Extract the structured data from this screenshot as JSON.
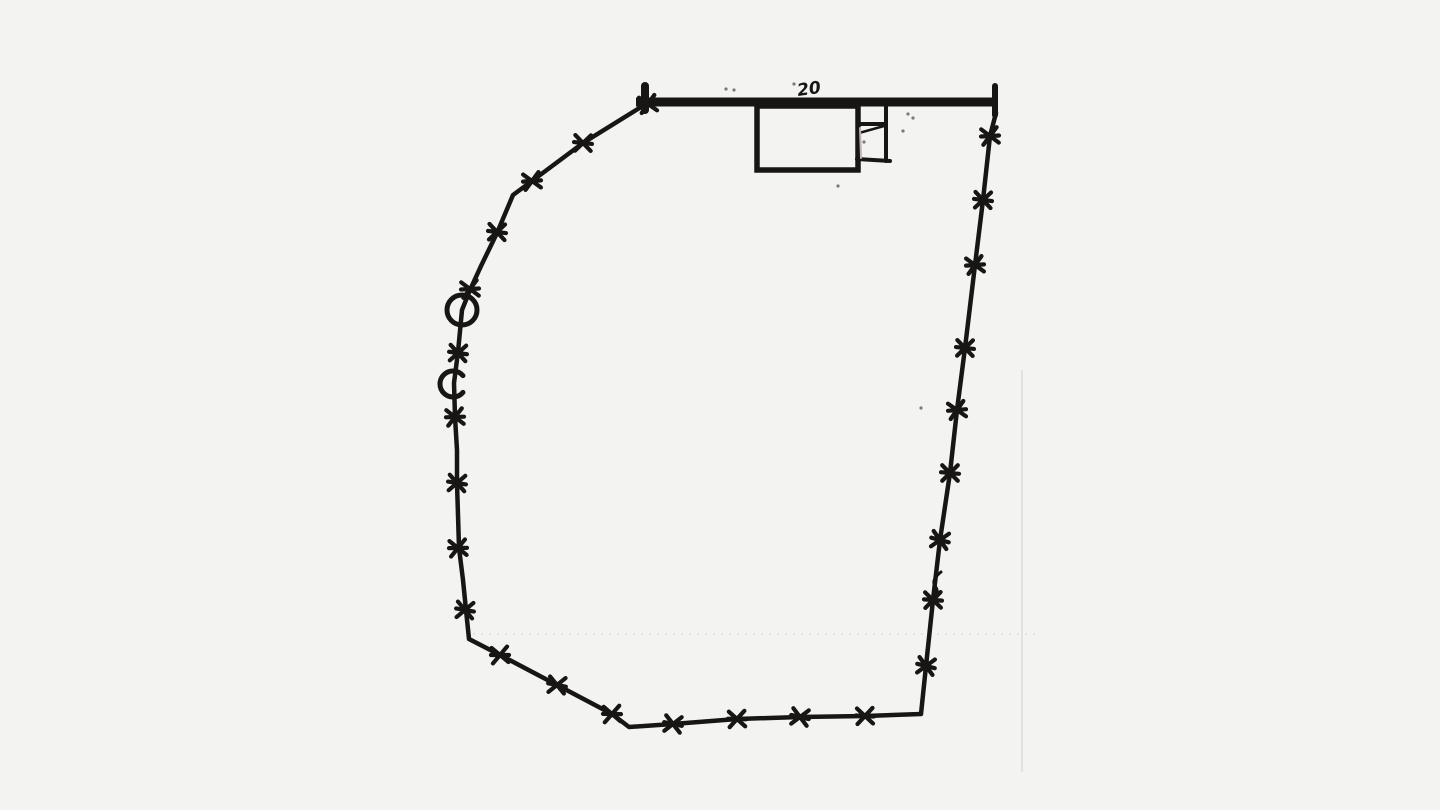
{
  "annotation": {
    "dimension_label": "20"
  },
  "colors": {
    "paper": "#f3f3f1",
    "ink": "#181614",
    "faint": "#dcdcd8",
    "pencil": "#b9b5ae"
  },
  "geometry": {
    "canvas": {
      "width": 1440,
      "height": 810
    },
    "top_wall": {
      "x1": 636,
      "y1": 102,
      "x2": 997,
      "y2": 102,
      "thickness": 9,
      "left_tick": {
        "x": 645,
        "y1": 86,
        "y2": 110,
        "thickness": 8
      },
      "right_cap": {
        "x": 995,
        "y1": 86,
        "y2": 115,
        "thickness": 6
      }
    },
    "dimension_label_pos": {
      "x": 798,
      "y": 96,
      "rotation": -8,
      "size": 17
    },
    "building": {
      "main_rect": {
        "x": 757,
        "y": 106,
        "w": 101,
        "h": 64,
        "stroke_w": 5.5
      },
      "annex": {
        "right_wall": {
          "x1": 886,
          "y1": 106,
          "x2": 886,
          "y2": 161,
          "w": 4
        },
        "divider": {
          "x1": 860,
          "y1": 124,
          "x2": 886,
          "y2": 124,
          "w": 4
        },
        "diagonal": {
          "x1": 859,
          "y1": 133,
          "x2": 884,
          "y2": 126,
          "w": 2.5
        },
        "bottom": {
          "x1": 857,
          "y1": 159,
          "x2": 890,
          "y2": 161,
          "w": 4
        },
        "pencil_mark": {
          "x1": 860,
          "y1": 128,
          "x2": 861,
          "y2": 158,
          "w": 2
        }
      }
    },
    "boundary": {
      "stroke_w": 4.5,
      "points": [
        [
          641,
          107
        ],
        [
          583,
          143
        ],
        [
          532,
          181
        ],
        [
          513,
          195
        ],
        [
          497,
          233
        ],
        [
          481,
          266
        ],
        [
          470,
          290
        ],
        [
          462,
          310
        ],
        [
          458,
          352
        ],
        [
          454,
          383
        ],
        [
          455,
          417
        ],
        [
          457,
          450
        ],
        [
          457,
          483
        ],
        [
          458,
          515
        ],
        [
          459,
          548
        ],
        [
          463,
          580
        ],
        [
          466,
          610
        ],
        [
          469,
          639
        ],
        [
          500,
          655
        ],
        [
          557,
          685
        ],
        [
          612,
          714
        ],
        [
          629,
          727
        ],
        [
          673,
          724
        ],
        [
          737,
          719
        ],
        [
          800,
          717
        ],
        [
          865,
          716
        ],
        [
          921,
          714
        ],
        [
          926,
          666
        ],
        [
          933,
          600
        ],
        [
          940,
          540
        ],
        [
          950,
          473
        ],
        [
          957,
          410
        ],
        [
          965,
          348
        ],
        [
          975,
          265
        ],
        [
          983,
          200
        ],
        [
          990,
          136
        ],
        [
          996,
          113
        ]
      ]
    },
    "posts": {
      "arm_length": 11,
      "stroke_w": 4.2,
      "positions": [
        [
          648,
          104
        ],
        [
          583,
          143
        ],
        [
          532,
          181
        ],
        [
          497,
          232
        ],
        [
          470,
          289
        ],
        [
          458,
          353
        ],
        [
          455,
          417
        ],
        [
          457,
          483
        ],
        [
          458,
          548
        ],
        [
          465,
          610
        ],
        [
          500,
          655
        ],
        [
          557,
          685
        ],
        [
          612,
          714
        ],
        [
          673,
          724
        ],
        [
          737,
          719
        ],
        [
          800,
          717
        ],
        [
          865,
          716
        ],
        [
          926,
          666
        ],
        [
          933,
          600
        ],
        [
          940,
          540
        ],
        [
          950,
          473
        ],
        [
          957,
          410
        ],
        [
          965,
          348
        ],
        [
          975,
          265
        ],
        [
          983,
          200
        ],
        [
          990,
          136
        ]
      ]
    },
    "circle_markers": [
      {
        "type": "closed",
        "x": 462,
        "y": 310,
        "r": 15,
        "stroke_w": 5
      },
      {
        "type": "open",
        "x": 453,
        "y": 384,
        "r": 13,
        "stroke_w": 5,
        "gap_start_deg": -40,
        "gap_end_deg": 40
      }
    ],
    "hook_squiggle": {
      "path": "M 941 572 Q 931 580 935 586 Q 939 591 936 597",
      "w": 3
    },
    "faint_lines": [
      {
        "type": "dotted-horizontal",
        "x1": 473,
        "y1": 634,
        "x2": 1037,
        "y2": 634,
        "w": 1.5,
        "dash": "2 6"
      },
      {
        "type": "fold-vertical",
        "x1": 1022,
        "y1": 370,
        "x2": 1022,
        "y2": 772,
        "w": 1.5,
        "dash": ""
      }
    ],
    "specks": [
      [
        726,
        89
      ],
      [
        734,
        90
      ],
      [
        908,
        114
      ],
      [
        913,
        118
      ],
      [
        903,
        131
      ],
      [
        864,
        142
      ],
      [
        794,
        84
      ],
      [
        921,
        408
      ],
      [
        838,
        186
      ]
    ]
  }
}
